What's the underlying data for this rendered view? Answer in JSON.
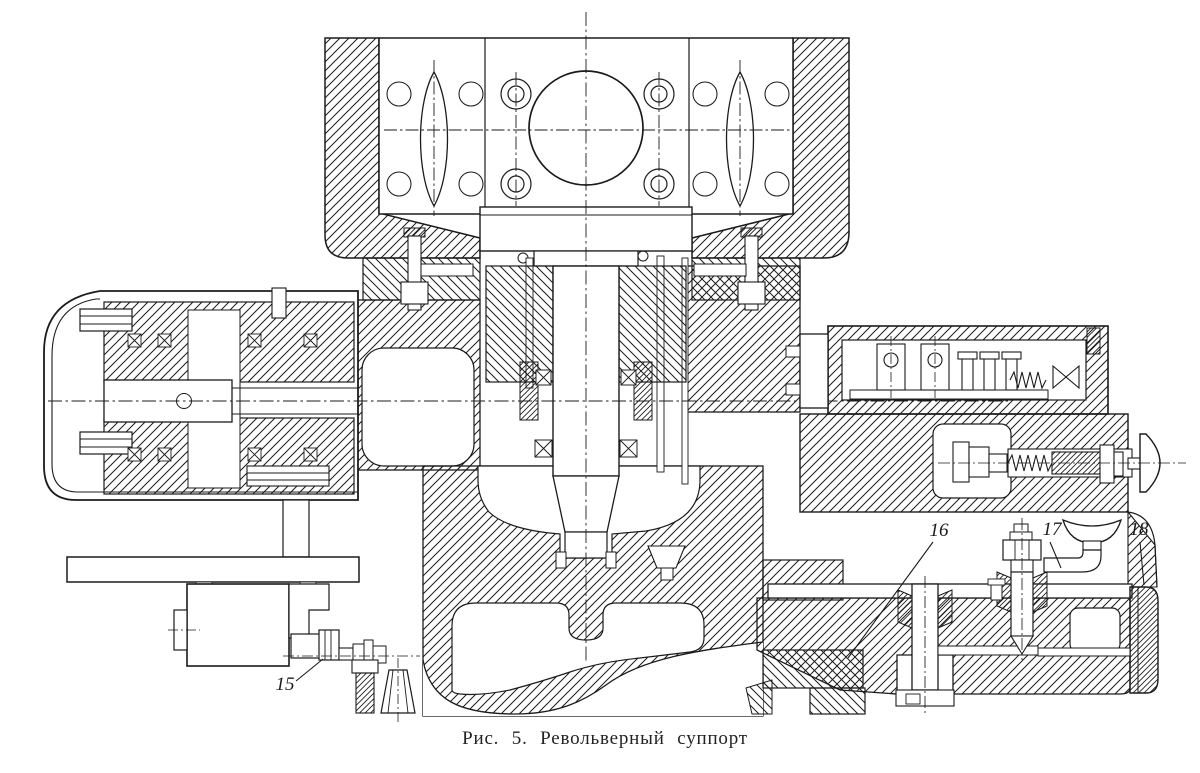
{
  "caption": {
    "full": "Рис. 5.  Револьверный суппорт",
    "figure_label": "Рис. 5.",
    "title": "Револьверный суппорт"
  },
  "callouts": [
    {
      "label": "15"
    },
    {
      "label": "16"
    },
    {
      "label": "17"
    },
    {
      "label": "18"
    }
  ],
  "colors": {
    "paper": "#ffffff",
    "ink": "#1b1b1b"
  }
}
